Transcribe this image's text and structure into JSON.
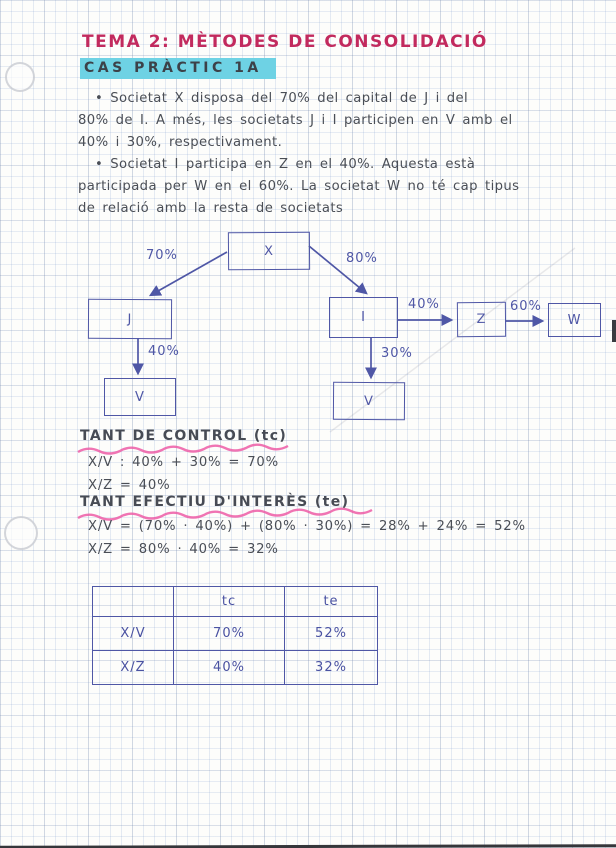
{
  "header": {
    "title": "TEMA 2: MÈTODES DE CONSOLIDACIÓ",
    "case_label": "CAS PRÀCTIC 1A"
  },
  "colors": {
    "title_pink": "#c22a5e",
    "highlight_cyan": "#6ed2e4",
    "ink_gray": "#4a4e56",
    "pen_blue": "#4f57a6",
    "underline_pink": "#ed5ca6",
    "grid_blue": "#c9d8ec"
  },
  "bullets": [
    {
      "lines": [
        "• Societat X disposa del 70% del capital de J i del",
        "80% de I. A més, les societats J i I participen en V amb el",
        "40% i 30%, respectivament."
      ]
    },
    {
      "lines": [
        "• Societat I participa en Z en el 40%. Aquesta està",
        "participada per W en el 60%. La societat W no té cap tipus",
        "de relació amb la resta de societats"
      ]
    }
  ],
  "diagram": {
    "nodes": [
      {
        "id": "x",
        "label": "X"
      },
      {
        "id": "j",
        "label": "J"
      },
      {
        "id": "i",
        "label": "I"
      },
      {
        "id": "z",
        "label": "Z"
      },
      {
        "id": "w",
        "label": "W"
      },
      {
        "id": "v1",
        "label": "V"
      },
      {
        "id": "v2",
        "label": "V"
      }
    ],
    "edges": [
      {
        "from": "X",
        "to": "J",
        "label": "70%"
      },
      {
        "from": "X",
        "to": "I",
        "label": "80%"
      },
      {
        "from": "I",
        "to": "Z",
        "label": "40%"
      },
      {
        "from": "Z",
        "to": "W",
        "label": "60%"
      },
      {
        "from": "J",
        "to": "V",
        "label": "40%"
      },
      {
        "from": "I",
        "to": "V",
        "label": "30%"
      }
    ]
  },
  "tc_section": {
    "heading": "TANT DE CONTROL (tc)",
    "lines": [
      "X/V : 40% + 30% = 70%",
      "X/Z = 40%"
    ]
  },
  "te_section": {
    "heading": "TANT EFECTIU D'INTERÈS (te)",
    "lines": [
      "X/V = (70% · 40%) + (80% · 30%) = 28% + 24% = 52%",
      "X/Z = 80% · 40% = 32%"
    ]
  },
  "table": {
    "headers": [
      "",
      "tc",
      "te"
    ],
    "rows": [
      [
        "X/V",
        "70%",
        "52%"
      ],
      [
        "X/Z",
        "40%",
        "32%"
      ]
    ]
  }
}
